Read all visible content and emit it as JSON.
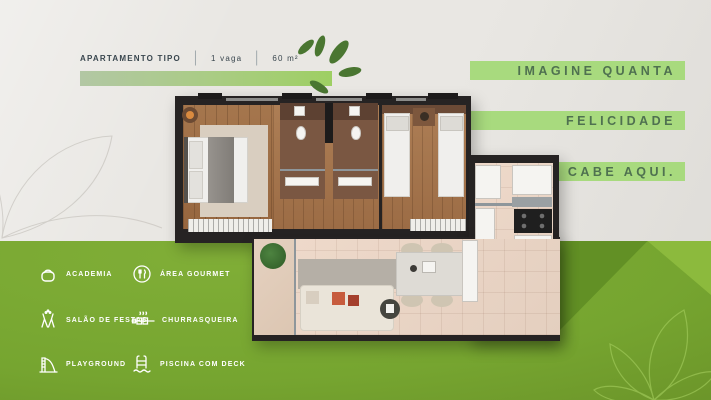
{
  "header": {
    "unit_label": "APARTAMENTO TIPO",
    "divider": "|",
    "parking": "1 vaga",
    "area": "60 m²"
  },
  "slogan": {
    "line1": "IMAGINE QUANTA",
    "line2": "FELICIDADE",
    "line3": "CABE AQUI."
  },
  "amenities": {
    "items": [
      {
        "icon": "kettlebell-icon",
        "label": "ACADEMIA"
      },
      {
        "icon": "cutlery-icon",
        "label": "ÁREA GOURMET"
      },
      {
        "icon": "champagne-glasses-icon",
        "label": "SALÃO DE FESTAS"
      },
      {
        "icon": "barbecue-skewer-icon",
        "label": "CHURRASQUEIRA"
      },
      {
        "icon": "slide-icon",
        "label": "PLAYGROUND"
      },
      {
        "icon": "pool-ladder-icon",
        "label": "PISCINA COM DECK"
      }
    ]
  },
  "colors": {
    "green_background": "#76a530",
    "green_dark_band": "#5e8c23",
    "green_light_band": "#8fbc3f",
    "highlight_band": "#a8da7e",
    "slogan_text": "#4f7150",
    "header_text": "#39464e",
    "leaf_logo": "#4a7631",
    "gray_background": "#e9e7e3",
    "amenity_text": "#ffffff",
    "wall": "#262323",
    "wood_floor": "#9c6c45",
    "tile_floor": "#e8d4c5"
  }
}
